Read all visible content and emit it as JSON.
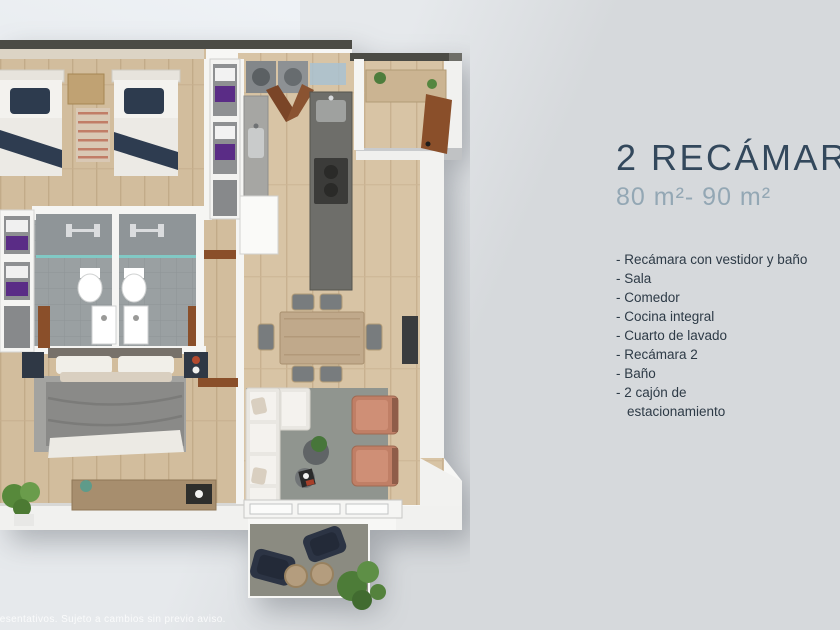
{
  "panel": {
    "title": "2 RECÁMAR",
    "area_range": "80 m²- 90 m²",
    "bullet": "- ",
    "features": [
      "Recámara con vestidor y baño",
      "Sala",
      "Comedor",
      "Cocina integral",
      "Cuarto de lavado",
      "Recámara 2",
      "Baño",
      "2 cajón de\nestacionamiento"
    ]
  },
  "footer": {
    "disclaimer": "resentativos. Sujeto a cambios sin previo aviso."
  },
  "palette": {
    "title_color": "#33485c",
    "subtitle_color": "#93a7b4",
    "list_color": "#2d3a46",
    "background": "#d6d9dc",
    "background_light": "#e6e9ec",
    "slab_white": "#f7f7f5",
    "wood_floor": "#d8c4a5",
    "tile_gray": "#9aa0a2",
    "navy_accent": "#2d3b4e",
    "purple_towel": "#5a2c86",
    "terracotta_chair": "#c07f66",
    "door_wood": "#8a4f2a",
    "balcony_floor": "#8b8b81"
  }
}
